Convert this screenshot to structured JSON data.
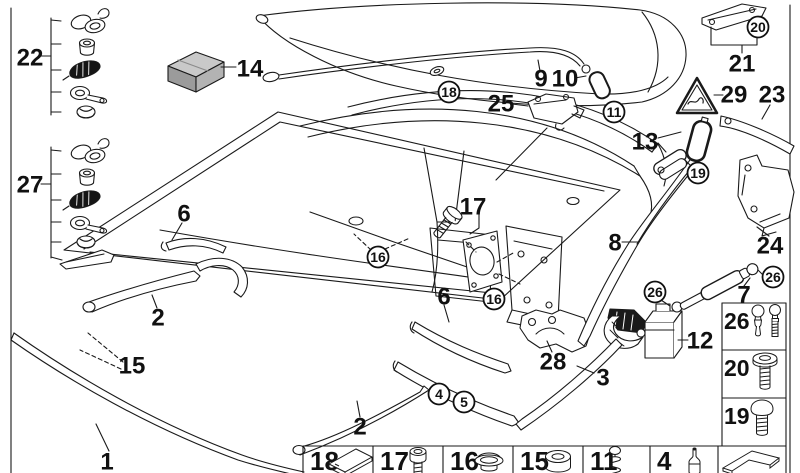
{
  "page": {
    "background": "#ffffff",
    "line_color": "#1a1a1a"
  },
  "kit_box": {
    "top": "#c9c9c9",
    "front": "#9b9b9b",
    "side": "#b3b3b3"
  },
  "callouts": {
    "plain": [
      {
        "label": "22",
        "x": 30,
        "y": 57
      },
      {
        "label": "27",
        "x": 30,
        "y": 184
      },
      {
        "label": "14",
        "x": 250,
        "y": 68
      },
      {
        "label": "9",
        "x": 541,
        "y": 78
      },
      {
        "label": "10",
        "x": 565,
        "y": 78
      },
      {
        "label": "25",
        "x": 501,
        "y": 103
      },
      {
        "label": "21",
        "x": 742,
        "y": 63
      },
      {
        "label": "29",
        "x": 734,
        "y": 94
      },
      {
        "label": "23",
        "x": 772,
        "y": 94
      },
      {
        "label": "13",
        "x": 645,
        "y": 141
      },
      {
        "label": "8",
        "x": 615,
        "y": 242
      },
      {
        "label": "24",
        "x": 770,
        "y": 245
      },
      {
        "label": "7",
        "x": 744,
        "y": 294
      },
      {
        "label": "12",
        "x": 700,
        "y": 340
      },
      {
        "label": "17",
        "x": 473,
        "y": 206
      },
      {
        "label": "6",
        "x": 184,
        "y": 213
      },
      {
        "label": "6",
        "x": 444,
        "y": 296
      },
      {
        "label": "28",
        "x": 553,
        "y": 361
      },
      {
        "label": "3",
        "x": 603,
        "y": 377
      },
      {
        "label": "2",
        "x": 158,
        "y": 317
      },
      {
        "label": "15",
        "x": 132,
        "y": 365
      },
      {
        "label": "2",
        "x": 360,
        "y": 426
      },
      {
        "label": "1",
        "x": 107,
        "y": 461
      }
    ],
    "circled": [
      {
        "label": "18",
        "x": 449,
        "y": 92
      },
      {
        "label": "11",
        "x": 614,
        "y": 112
      },
      {
        "label": "20",
        "x": 758,
        "y": 27
      },
      {
        "label": "19",
        "x": 698,
        "y": 173
      },
      {
        "label": "16",
        "x": 378,
        "y": 257
      },
      {
        "label": "16",
        "x": 494,
        "y": 299
      },
      {
        "label": "26",
        "x": 655,
        "y": 292
      },
      {
        "label": "26",
        "x": 773,
        "y": 277
      },
      {
        "label": "4",
        "x": 439,
        "y": 394
      },
      {
        "label": "5",
        "x": 464,
        "y": 402
      }
    ]
  },
  "legend_row": [
    {
      "number": "18",
      "icon": "pad-icon"
    },
    {
      "number": "17",
      "icon": "screw-icon"
    },
    {
      "number": "16",
      "icon": "cap-icon"
    },
    {
      "number": "15",
      "icon": "grommet-icon"
    },
    {
      "number": "11",
      "icon": "spring-icon"
    },
    {
      "number": "4",
      "icon": "pin-icon"
    },
    {
      "number": "",
      "icon": "folded-strip-icon"
    }
  ],
  "legend_column": [
    {
      "number": "26",
      "icon": "ball-pins-icon"
    },
    {
      "number": "20",
      "icon": "flange-bolt-icon"
    },
    {
      "number": "19",
      "icon": "ball-stud-icon"
    }
  ]
}
